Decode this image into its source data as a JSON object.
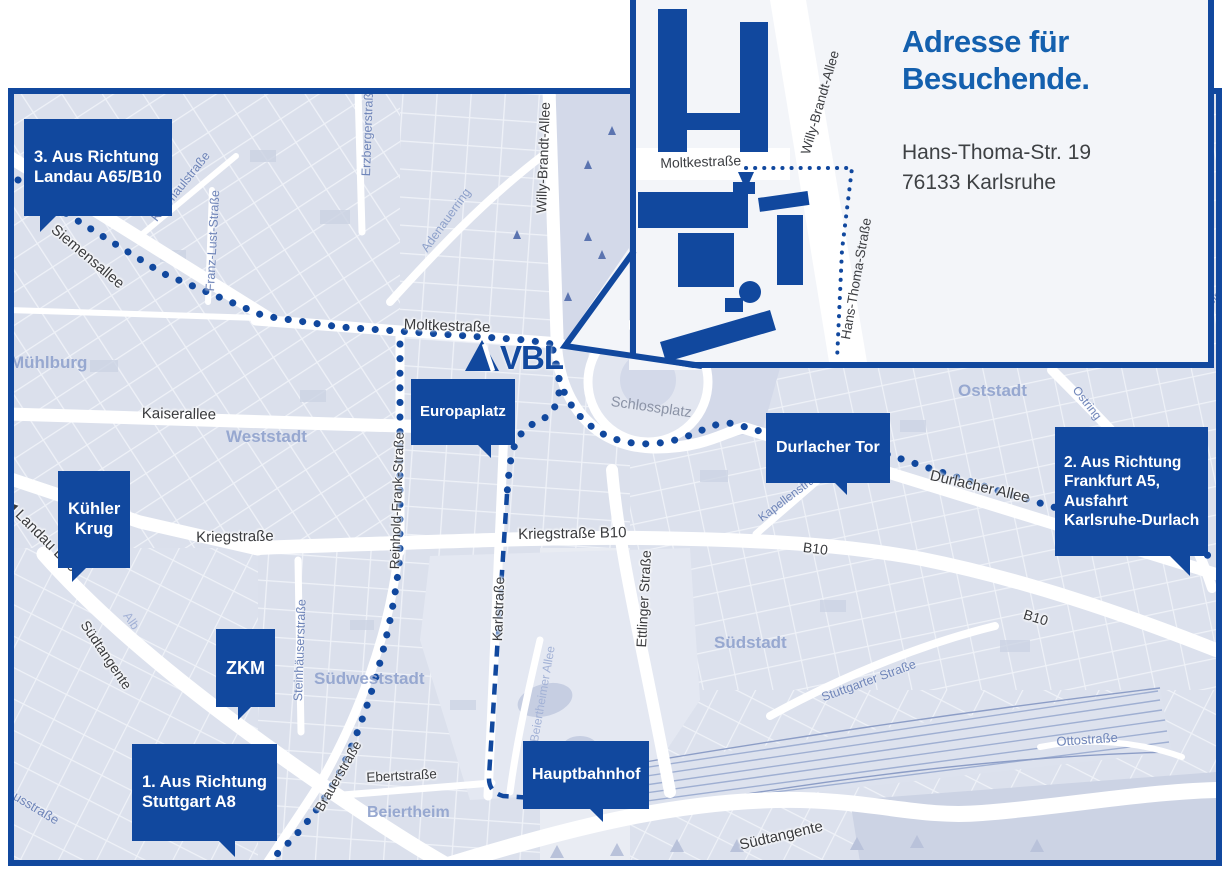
{
  "inset": {
    "title": "Adresse für\nBesuchende.",
    "address": "Hans-Thoma-Str. 19\n76133 Karlsruhe",
    "streets": [
      "Moltkestraße",
      "Willy-Brandt-Allee",
      "Hans-Thoma-Straße"
    ]
  },
  "logo": {
    "text": "VBL"
  },
  "badges": {
    "landau": "3. Aus Richtung\nLandau A65/B10",
    "kuehler_krug": "Kühler\nKrug",
    "zkm": "ZKM",
    "stuttgart": "1. Aus Richtung\nStuttgart A8",
    "europaplatz": "Europaplatz",
    "durlacher_tor": "Durlacher Tor",
    "hauptbahnhof": "Hauptbahnhof",
    "frankfurt": "2. Aus Richtung\nFrankfurt A5,\nAusfahrt\nKarlsruhe-Durlach"
  },
  "districts": [
    "Mühlburg",
    "Weststadt",
    "Oststadt",
    "Südstadt",
    "Südweststadt",
    "Beiertheim"
  ],
  "places": {
    "schlossplatz": "Schlossplatz"
  },
  "streets": [
    "Siemensallee",
    "Kußmaulstraße",
    "Franz-Lust-Straße",
    "Erzbergerstraße",
    "Adenauerring",
    "Willy-Brandt-Allee",
    "Moltkestraße",
    "Kaiserallee",
    "Reinhold-Frank-Straße",
    "Kriegstraße",
    "Kriegstraße B10",
    "B10",
    "B10",
    "Durlacher Allee",
    "Kapellenstraße",
    "Ostring",
    "Ostring",
    "◀ Landau B10",
    "Südtangente",
    "Alb",
    "Steinhäuserstraße",
    "Karlstraße",
    "Ettlinger Straße",
    "Beiertheimer Allee",
    "Brauerstraße",
    "Ebertstraße",
    "Stuttgarter Straße",
    "Südtangente",
    "Ottostraße",
    "Pulverhausstraße",
    "ein"
  ],
  "colors": {
    "navy": "#11489e",
    "title_blue": "#1460ae",
    "map_bg": "#e9ecf3"
  }
}
